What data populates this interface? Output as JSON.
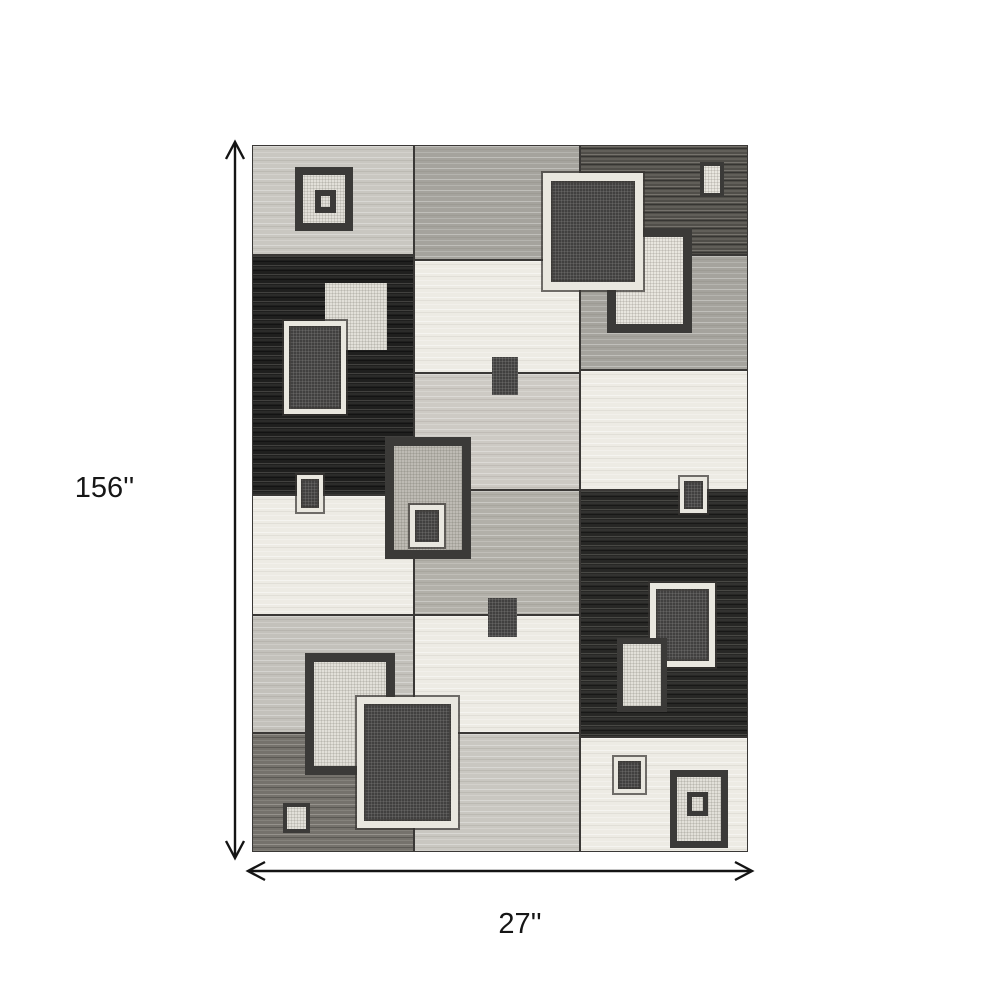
{
  "dimension_labels": {
    "height": "156''",
    "width": "27''"
  },
  "colors": {
    "page_bg": "#ffffff",
    "seam": "#3a3836",
    "arrow": "#141414",
    "label_text": "#161616",
    "cream": "#edebe4",
    "white": "#f3f1ea",
    "light_gray": "#c9c7c1",
    "light_gray2": "#c3c1bb",
    "pale_gray": "#cdcac4",
    "gray": "#a5a39d",
    "gray2": "#b2b0a9",
    "mid_dark": "#75726c",
    "dark": "#504e49",
    "black": "#1f1f1e",
    "black2": "#272725",
    "dark_fill": "#383736",
    "gray_motif": "#c6c3bc",
    "dark_border": "#3b3a38",
    "cream_border": "#e9e7df"
  },
  "icons": {
    "vertical_dimension": "double-headed-arrow-vertical",
    "horizontal_dimension": "double-headed-arrow-horizontal"
  },
  "rug": {
    "blocks": [
      {
        "x": 0,
        "y": 0,
        "w": 162,
        "h": 110,
        "fill": "light_gray",
        "tex": "streaks-light"
      },
      {
        "x": 0,
        "y": 110,
        "w": 162,
        "h": 240,
        "fill": "black",
        "tex": "streaks-black"
      },
      {
        "x": 0,
        "y": 350,
        "w": 162,
        "h": 120,
        "fill": "cream",
        "tex": "streaks-cream"
      },
      {
        "x": 0,
        "y": 470,
        "w": 162,
        "h": 118,
        "fill": "light_gray2",
        "tex": "streaks-light"
      },
      {
        "x": 0,
        "y": 588,
        "w": 162,
        "h": 119,
        "fill": "mid_dark",
        "tex": "streaks-mid"
      },
      {
        "x": 162,
        "y": 0,
        "w": 166,
        "h": 115,
        "fill": "gray",
        "tex": "streaks-light"
      },
      {
        "x": 162,
        "y": 115,
        "w": 166,
        "h": 113,
        "fill": "cream",
        "tex": "streaks-cream"
      },
      {
        "x": 162,
        "y": 228,
        "w": 166,
        "h": 117,
        "fill": "pale_gray",
        "tex": "streaks-light"
      },
      {
        "x": 162,
        "y": 345,
        "w": 166,
        "h": 125,
        "fill": "gray2",
        "tex": "streaks-light"
      },
      {
        "x": 162,
        "y": 470,
        "w": 166,
        "h": 118,
        "fill": "cream",
        "tex": "streaks-cream"
      },
      {
        "x": 162,
        "y": 588,
        "w": 166,
        "h": 119,
        "fill": "light_gray",
        "tex": "streaks-light"
      },
      {
        "x": 328,
        "y": 0,
        "w": 168,
        "h": 110,
        "fill": "dark",
        "tex": "streaks-darkstrong"
      },
      {
        "x": 328,
        "y": 110,
        "w": 168,
        "h": 115,
        "fill": "gray",
        "tex": "streaks-light"
      },
      {
        "x": 328,
        "y": 225,
        "w": 168,
        "h": 120,
        "fill": "cream",
        "tex": "streaks-cream"
      },
      {
        "x": 328,
        "y": 345,
        "w": 168,
        "h": 247,
        "fill": "black2",
        "tex": "streaks-black"
      },
      {
        "x": 328,
        "y": 592,
        "w": 168,
        "h": 115,
        "fill": "cream",
        "tex": "streaks-cream"
      }
    ],
    "motifs": [
      {
        "x": 43,
        "y": 22,
        "w": 58,
        "h": 64,
        "bw": 8,
        "border": "dark_border",
        "fill": "cream",
        "tex": "speckle-light"
      },
      {
        "x": 63,
        "y": 45,
        "w": 21,
        "h": 23,
        "bw": 6,
        "border": "dark_border",
        "fill": "cream",
        "tex": "speckle-light"
      },
      {
        "x": 73,
        "y": 138,
        "w": 62,
        "h": 67,
        "bw": 0,
        "border": "dark_border",
        "fill": "cream",
        "tex": "speckle-light"
      },
      {
        "x": 32,
        "y": 176,
        "w": 62,
        "h": 93,
        "bw": 5,
        "border": "cream_border",
        "fill": "dark_fill",
        "tex": "speckle-dark"
      },
      {
        "x": 133,
        "y": 292,
        "w": 86,
        "h": 122,
        "bw": 9,
        "border": "dark_border",
        "fill": "gray_motif",
        "tex": "speckle-light"
      },
      {
        "x": 158,
        "y": 360,
        "w": 34,
        "h": 42,
        "bw": 5,
        "border": "cream_border",
        "fill": "dark_fill",
        "tex": "speckle-dark"
      },
      {
        "x": 240,
        "y": 212,
        "w": 26,
        "h": 38,
        "bw": 0,
        "border": "dark_border",
        "fill": "dark_fill",
        "tex": "speckle-dark"
      },
      {
        "x": 236,
        "y": 453,
        "w": 29,
        "h": 39,
        "bw": 0,
        "border": "dark_border",
        "fill": "dark_fill",
        "tex": "speckle-dark"
      },
      {
        "x": 45,
        "y": 330,
        "w": 26,
        "h": 37,
        "bw": 4,
        "border": "cream_border",
        "fill": "dark_fill",
        "tex": "speckle-dark"
      },
      {
        "x": 355,
        "y": 83,
        "w": 85,
        "h": 105,
        "bw": 9,
        "border": "dark_border",
        "fill": "white",
        "tex": "speckle-light"
      },
      {
        "x": 291,
        "y": 28,
        "w": 100,
        "h": 117,
        "bw": 8,
        "border": "cream_border",
        "fill": "dark_fill",
        "tex": "speckle-dark"
      },
      {
        "x": 428,
        "y": 332,
        "w": 27,
        "h": 36,
        "bw": 4,
        "border": "cream_border",
        "fill": "dark_fill",
        "tex": "speckle-dark"
      },
      {
        "x": 398,
        "y": 438,
        "w": 65,
        "h": 84,
        "bw": 6,
        "border": "cream_border",
        "fill": "dark_fill",
        "tex": "speckle-dark"
      },
      {
        "x": 365,
        "y": 493,
        "w": 50,
        "h": 74,
        "bw": 6,
        "border": "dark_border",
        "fill": "cream",
        "tex": "speckle-light"
      },
      {
        "x": 53,
        "y": 508,
        "w": 90,
        "h": 122,
        "bw": 9,
        "border": "dark_border",
        "fill": "cream",
        "tex": "speckle-light"
      },
      {
        "x": 105,
        "y": 552,
        "w": 101,
        "h": 131,
        "bw": 7,
        "border": "cream_border",
        "fill": "dark_fill",
        "tex": "speckle-dark"
      },
      {
        "x": 31,
        "y": 658,
        "w": 27,
        "h": 30,
        "bw": 4,
        "border": "dark_border",
        "fill": "cream",
        "tex": "speckle-light"
      },
      {
        "x": 362,
        "y": 612,
        "w": 31,
        "h": 36,
        "bw": 4,
        "border": "cream_border",
        "fill": "dark_fill",
        "tex": "speckle-dark"
      },
      {
        "x": 418,
        "y": 625,
        "w": 58,
        "h": 78,
        "bw": 7,
        "border": "dark_border",
        "fill": "cream",
        "tex": "speckle-light"
      },
      {
        "x": 435,
        "y": 647,
        "w": 21,
        "h": 24,
        "bw": 5,
        "border": "dark_border",
        "fill": "cream",
        "tex": "speckle-light"
      },
      {
        "x": 448,
        "y": 17,
        "w": 24,
        "h": 35,
        "bw": 4,
        "border": "dark_border",
        "fill": "white",
        "tex": "speckle-light"
      }
    ]
  }
}
